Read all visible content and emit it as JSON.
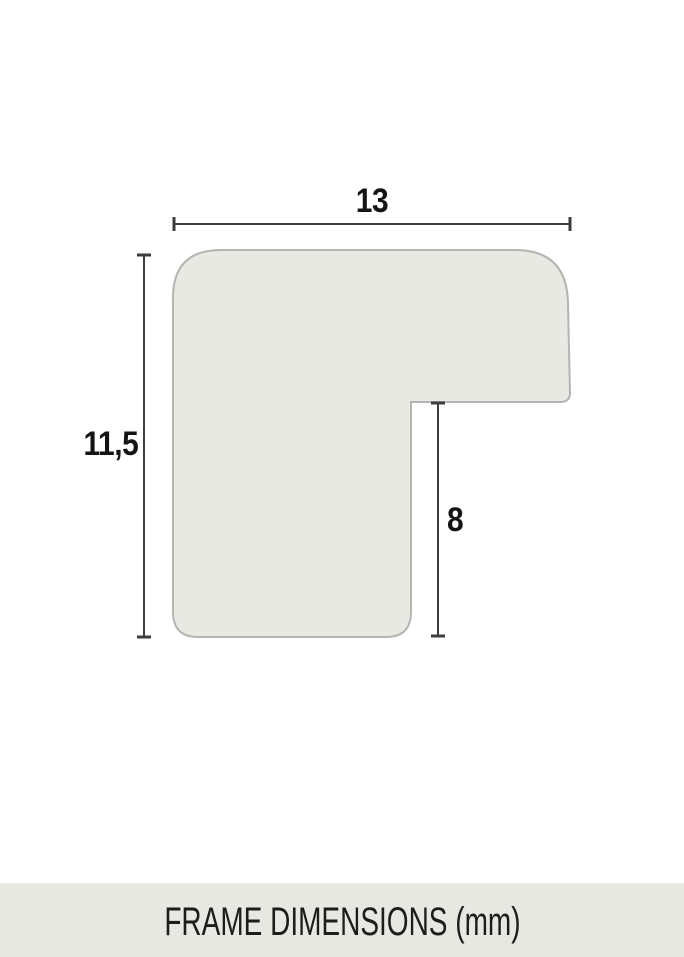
{
  "diagram": {
    "title": "Frame profile cross-section with dimensions",
    "dimensions": {
      "width_mm": "13",
      "height_mm": "11,5",
      "rabbet_depth_mm": "8"
    },
    "colors": {
      "shape_fill": "#e9e9e4",
      "shape_stroke": "#b4b4b0",
      "dimension_line": "#3d3d3d",
      "label_text": "#141414",
      "footer_background": "#e8e8e3",
      "footer_text": "#1d1d1b",
      "page_background": "#ffffff"
    }
  },
  "footer": {
    "title": "FRAME DIMENSIONS (mm)"
  }
}
